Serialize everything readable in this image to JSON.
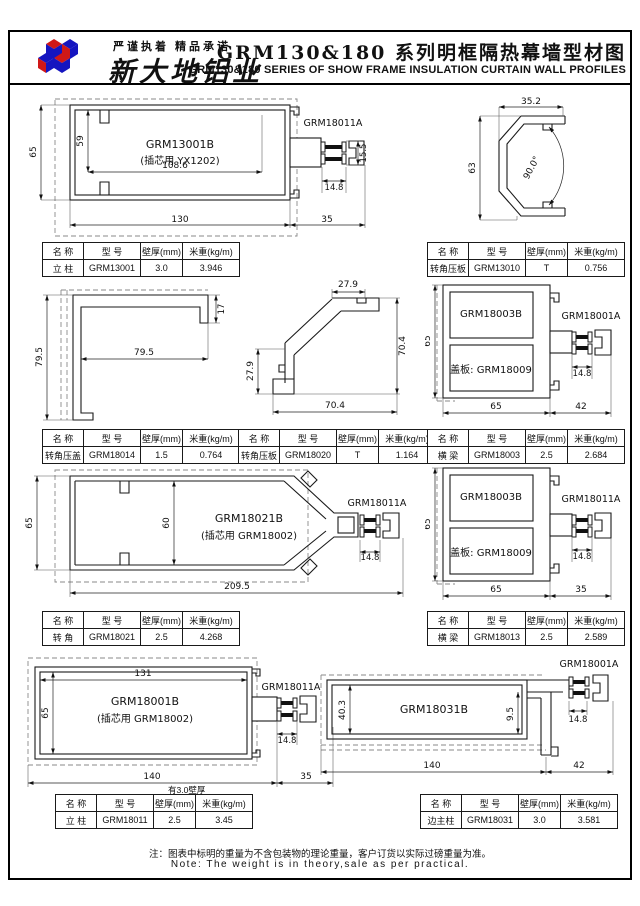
{
  "header": {
    "slogan": "严谨执着 精品承诺",
    "company": "新大地铝业",
    "title_cn": "GRM130&180 系列明框隔热幕墙型材图",
    "title_en": "GRM130&180 SERIES OF SHOW FRAME INSULATION CURTAIN WALL PROFILES"
  },
  "footer": {
    "note_cn": "注：图表中标明的重量为不含包装物的理论重量，客户订货以实际过磅重量为准。",
    "note_en": "Note: The weight is in theory,sale as per practical."
  },
  "table_headers": [
    "名 称",
    "型 号",
    "壁厚(mm)",
    "米重(kg/m)"
  ],
  "tables": [
    {
      "name": "立 柱",
      "model": "GRM13001",
      "thickness": "3.0",
      "weight": "3.946"
    },
    {
      "name": "转角压板",
      "model": "GRM13010",
      "thickness": "T",
      "weight": "0.756"
    },
    {
      "name": "转角压盖",
      "model": "GRM18014",
      "thickness": "1.5",
      "weight": "0.764"
    },
    {
      "name": "转角压板",
      "model": "GRM18020",
      "thickness": "T",
      "weight": "1.164"
    },
    {
      "name": "横 梁",
      "model": "GRM18003",
      "thickness": "2.5",
      "weight": "2.684"
    },
    {
      "name": "转 角",
      "model": "GRM18021",
      "thickness": "2.5",
      "weight": "4.268"
    },
    {
      "name": "横 梁",
      "model": "GRM18013",
      "thickness": "2.5",
      "weight": "2.589"
    },
    {
      "name": "立 柱",
      "model": "GRM18011",
      "thickness": "2.5",
      "weight": "3.45"
    },
    {
      "name": "边主柱",
      "model": "GRM18031",
      "thickness": "3.0",
      "weight": "3.581"
    }
  ],
  "drawings": {
    "d1": {
      "label": "GRM13001B",
      "sublabel": "(插芯用 YX1202)",
      "part": "GRM18011A",
      "dims": {
        "h_outer": "65",
        "h_inner": "59",
        "w_inner": "108.6",
        "w_body": "130",
        "w_right": "35",
        "h_conn": "15.5",
        "w_conn": "14.8"
      }
    },
    "d2": {
      "dims": {
        "w_top": "35.2",
        "h_left": "63",
        "angle": "90.0°"
      }
    },
    "d3": {
      "dims": {
        "h_left": "79.5",
        "w_inner": "79.5",
        "h_lip": "17"
      }
    },
    "d4": {
      "dims": {
        "w_top": "27.9",
        "h_leg": "27.9",
        "h_right": "70.4",
        "w_bottom": "70.4"
      }
    },
    "d5": {
      "label": "GRM18003B",
      "cover": "盖板: GRM18009",
      "part": "GRM18001A",
      "dims": {
        "h_left": "65",
        "w_conn": "14.8",
        "w_body": "65",
        "w_right": "42"
      }
    },
    "d6": {
      "label": "GRM18021B",
      "sublabel": "(插芯用 GRM18002)",
      "part": "GRM18011A",
      "dims": {
        "h_left": "65",
        "h_inner": "60",
        "w_conn": "14.8",
        "w_bottom": "209.5"
      }
    },
    "d7": {
      "label": "GRM18003B",
      "cover": "盖板: GRM18009",
      "part": "GRM18011A",
      "dims": {
        "h_left": "65",
        "w_conn": "14.8",
        "w_body": "65",
        "w_right": "35"
      }
    },
    "d8": {
      "label": "GRM18001B",
      "sublabel": "(插芯用 GRM18002)",
      "part": "GRM18011A",
      "note": "有3.0壁厚",
      "dims": {
        "w_top": "131",
        "h_left": "65",
        "w_conn": "14.8",
        "w_body": "140",
        "w_right": "35"
      }
    },
    "d9": {
      "label": "GRM18031B",
      "part": "GRM18001A",
      "dims": {
        "h_left": "40.3",
        "h_inner": "9.5",
        "w_conn": "14.8",
        "w_body": "140",
        "w_right": "42"
      }
    }
  },
  "brand_colors": {
    "blue": "#1515c0",
    "red": "#d01818",
    "line": "#1a1a1a"
  }
}
